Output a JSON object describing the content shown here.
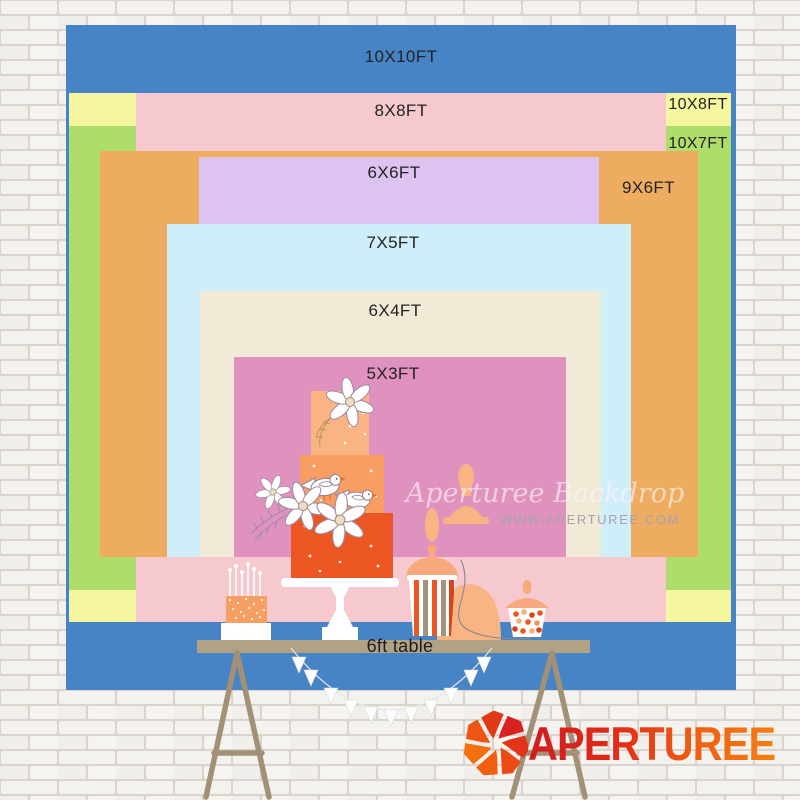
{
  "chart_title": "Backdrop size comparison chart",
  "sizes": [
    {
      "label": "10X10FT",
      "width_ft": 10,
      "height_ft": 10,
      "color": "#4784c6"
    },
    {
      "label": "8X8FT",
      "width_ft": 8,
      "height_ft": 8,
      "color": "#f5c9cd"
    },
    {
      "label": "10X8FT",
      "width_ft": 10,
      "height_ft": 8,
      "color": "#f7f6a0"
    },
    {
      "label": "10X7FT",
      "width_ft": 10,
      "height_ft": 7,
      "color": "#aedd6c"
    },
    {
      "label": "6X6FT",
      "width_ft": 6,
      "height_ft": 6,
      "color": "#dcc3f0"
    },
    {
      "label": "9X6FT",
      "width_ft": 9,
      "height_ft": 6,
      "color": "#edac60"
    },
    {
      "label": "7X5FT",
      "width_ft": 7,
      "height_ft": 5,
      "color": "#cfeefa"
    },
    {
      "label": "6X4FT",
      "width_ft": 6,
      "height_ft": 4,
      "color": "#f0ead6"
    },
    {
      "label": "5X3FT",
      "width_ft": 5,
      "height_ft": 3,
      "color": "#e092be"
    }
  ],
  "table": {
    "label": "6ft table",
    "color": "#b1a185"
  },
  "watermark": {
    "line1": "Aperturee Backdrop",
    "line2": "WWW.APERTUREE.COM"
  },
  "brand": {
    "logo_text": "APERTUREE",
    "logo_red": "#d92120",
    "logo_orange": "#f15f10"
  },
  "scene": {
    "background": "white painted brick wall",
    "illustrations": [
      "three-tier orange cake with white flowers and birds",
      "candle cake",
      "striped popcorn box",
      "candy jars",
      "white pennant banner",
      "wooden trestle table"
    ]
  }
}
